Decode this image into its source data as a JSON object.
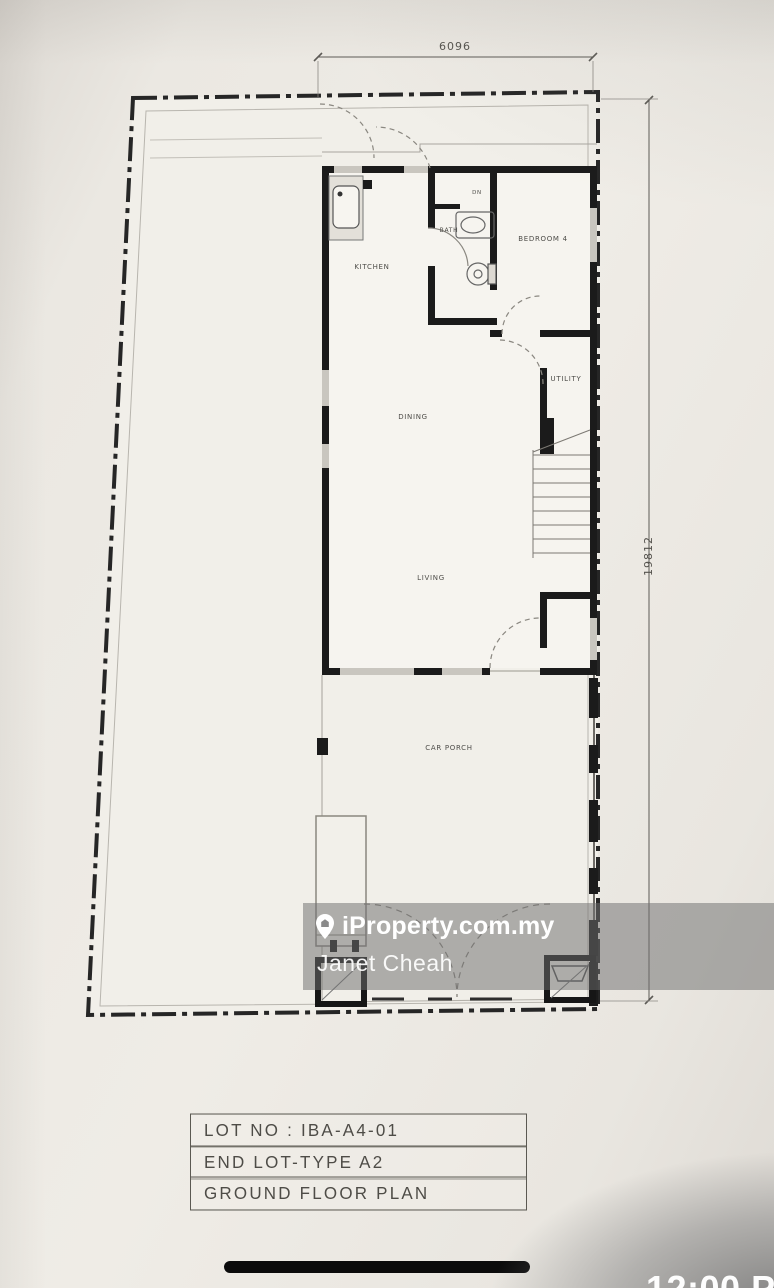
{
  "floor_plan": {
    "dimension_top": "6096",
    "dimension_right": "19812",
    "labels": {
      "kitchen": "KITCHEN",
      "bath": "BATH",
      "dn": "DN",
      "bedroom4": "BEDROOM 4",
      "utility": "UTILITY",
      "dining": "DINING",
      "living": "LIVING",
      "car_porch": "CAR PORCH"
    },
    "title_block": {
      "lot_no": "LOT NO : IBA-A4-01",
      "lot_type": "END LOT-TYPE A2",
      "plan_name": "GROUND FLOOR PLAN"
    }
  },
  "watermark": {
    "brand": "iProperty.com.my",
    "agent_name": "Janet Cheah",
    "band_color": "rgba(112,112,112,0.52)"
  },
  "system_overlay": {
    "time_partial": "12:00 PM"
  }
}
